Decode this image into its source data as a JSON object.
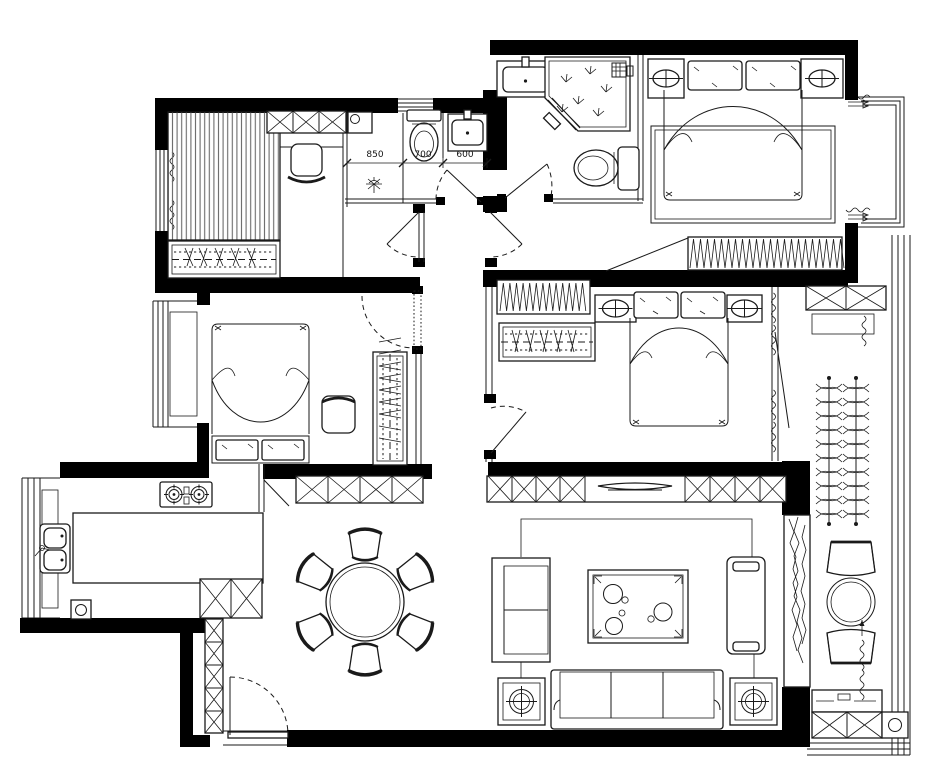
{
  "palette": {
    "ink": "#1a1a1a",
    "paper": "#ffffff",
    "wall_fill": "#000000",
    "stripe_gray": "#666666"
  },
  "dimensions": {
    "wash_zone": "850",
    "toilet_zone": "700",
    "basin_zone": "600"
  },
  "symbols": [
    "tatami-platform",
    "hanger-wardrobe",
    "desk-chair",
    "storage-xbox-cabinet",
    "washing-machine",
    "toilet",
    "basin",
    "floor-drain",
    "corner-shower",
    "double-bed",
    "nightstand-lamp",
    "pillow",
    "area-rug",
    "coil-wardrobe",
    "bay-window",
    "radiator-coil",
    "stool",
    "pocket-door",
    "swing-door",
    "round-dining-table",
    "dining-chair",
    "gas-stove",
    "kitchen-island",
    "double-sink",
    "small-appliance",
    "shoe-cabinet",
    "entry-door",
    "tv-console",
    "tv-screen",
    "armchair",
    "chaise-lounge",
    "coffee-table",
    "tea-set",
    "three-seat-sofa",
    "side-table-lamp",
    "balcony-plants",
    "marble-threshold",
    "balcony-chair",
    "balcony-round-table",
    "laundry-cabinet"
  ]
}
